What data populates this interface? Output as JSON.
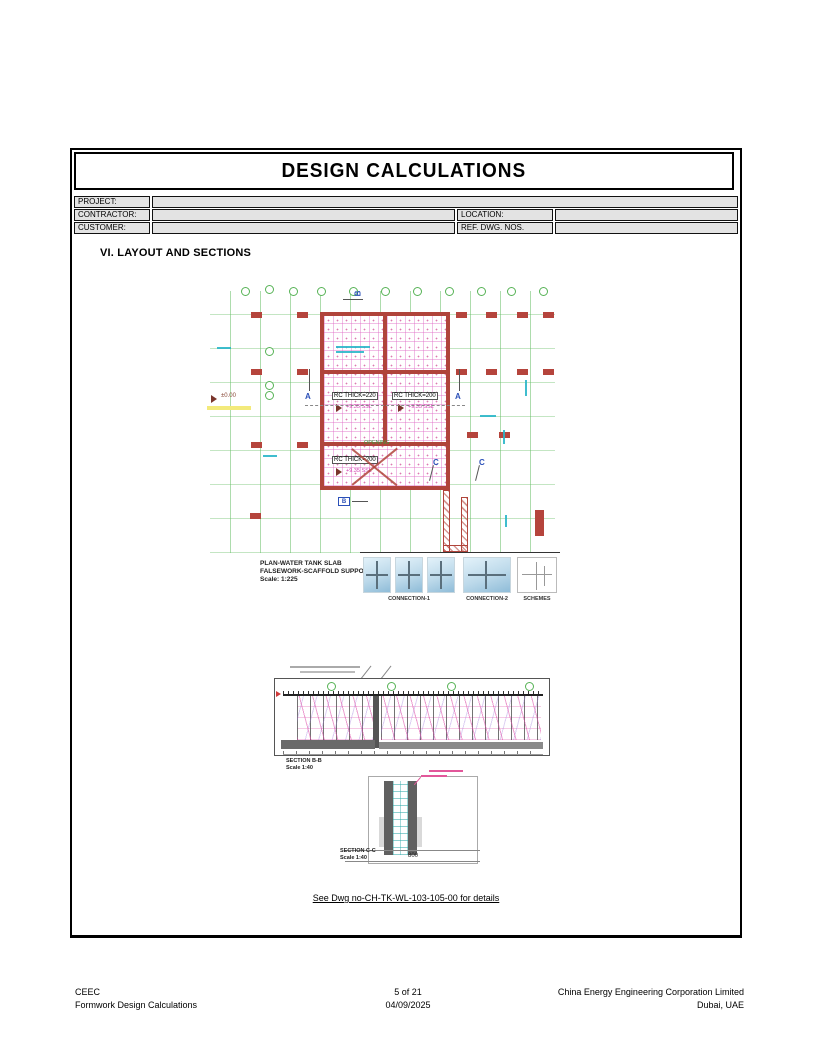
{
  "doc": {
    "title": "DESIGN CALCULATIONS"
  },
  "meta_table": {
    "project_label": "PROJECT:",
    "project_value": "",
    "contractor_label": "CONTRACTOR:",
    "contractor_value": "",
    "customer_label": "CUSTOMER:",
    "customer_value": "",
    "location_label": "LOCATION:",
    "location_value": "",
    "ref_dwg_label": "REF. DWG. NOS.",
    "ref_dwg_value": ""
  },
  "section_heading": "VI. LAYOUT AND SECTIONS",
  "plan": {
    "slab_labels": [
      {
        "thickness": "RC THICK=220",
        "level": "+9.35 SSL"
      },
      {
        "thickness": "RC THICK=200",
        "level": "+9.35 SSL"
      },
      {
        "thickness": "RC THICK=200",
        "level": "+9.35 SSL"
      }
    ],
    "level_datum": "±0.00",
    "opening_note": "OPENING",
    "section_markers": {
      "a": "A",
      "b": "B",
      "c": "C"
    },
    "caption": {
      "line1": "PLAN-WATER TANK SLAB",
      "line2": "FALSEWORK-SCAFFOLD SUPPORT",
      "line3": "Scale: 1:225"
    },
    "detail_labels": {
      "connection1": "CONNECTION-1",
      "connection2": "CONNECTION-2",
      "schemes": "SCHEMES"
    }
  },
  "section_b": {
    "caption": "SECTION B-B",
    "scale": "Scale 1:40"
  },
  "section_c": {
    "caption": "SECTION C-C",
    "scale": "Scale 1:40",
    "width_dim": "800"
  },
  "reference_note": "See Dwg no-CH-TK-WL-103-105-00 for details",
  "footer": {
    "left_line1": "CEEC",
    "left_line2": "Formwork Design Calculations",
    "center_line1": "5 of 21",
    "center_line2": "04/09/2025",
    "right_line1": "China Energy Engineering Corporation Limited",
    "right_line2": "Dubai, UAE"
  },
  "colors": {
    "grid_green": "#57b356",
    "wall_red": "#b0443b",
    "scaffold_magenta": "#d85bb4",
    "dim_cyan": "#2ab6c9",
    "marker_blue": "#2b50b8",
    "flag_dark_red": "#7a352c"
  }
}
